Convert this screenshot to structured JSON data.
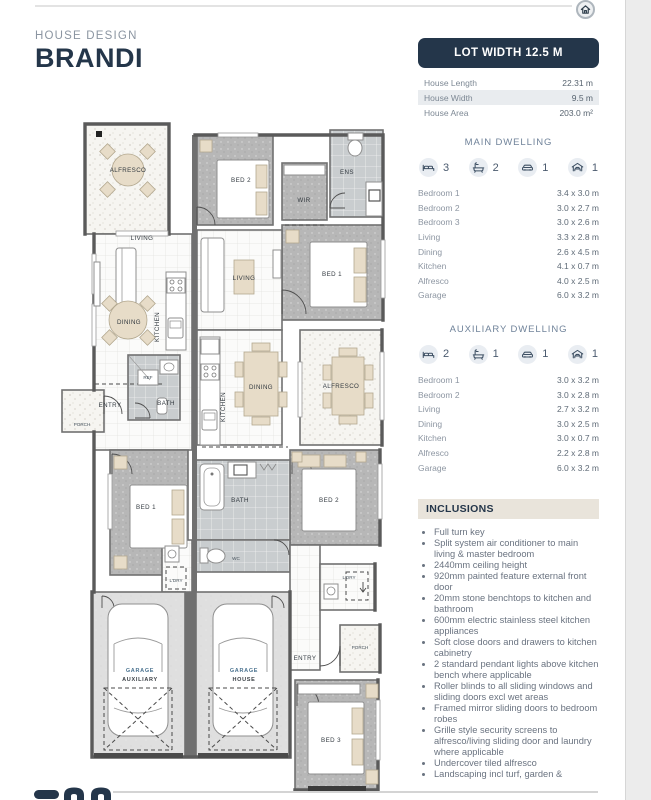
{
  "header": {
    "eyebrow": "HOUSE DESIGN",
    "title": "BRANDI"
  },
  "lot": {
    "header": "LOT WIDTH 12.5 M",
    "rows": [
      {
        "label": "House Length",
        "value": "22.31 m"
      },
      {
        "label": "House Width",
        "value": "9.5 m"
      },
      {
        "label": "House Area",
        "value": "203.0 m²"
      }
    ]
  },
  "main_dwelling": {
    "heading": "MAIN DWELLING",
    "stats": [
      {
        "icon": "bed-icon",
        "count": "3"
      },
      {
        "icon": "bath-icon",
        "count": "2"
      },
      {
        "icon": "car-icon",
        "count": "1"
      },
      {
        "icon": "garage-icon",
        "count": "1"
      }
    ],
    "rooms": [
      {
        "label": "Bedroom 1",
        "value": "3.4 x 3.0 m"
      },
      {
        "label": "Bedroom 2",
        "value": "3.0 x 2.7 m"
      },
      {
        "label": "Bedroom 3",
        "value": "3.0 x 2.6 m"
      },
      {
        "label": "Living",
        "value": "3.3 x 2.8 m"
      },
      {
        "label": "Dining",
        "value": "2.6 x 4.5 m"
      },
      {
        "label": "Kitchen",
        "value": "4.1 x 0.7 m"
      },
      {
        "label": "Alfresco",
        "value": "4.0 x 2.5 m"
      },
      {
        "label": "Garage",
        "value": "6.0 x 3.2 m"
      }
    ]
  },
  "auxiliary_dwelling": {
    "heading": "AUXILIARY DWELLING",
    "stats": [
      {
        "icon": "bed-icon",
        "count": "2"
      },
      {
        "icon": "bath-icon",
        "count": "1"
      },
      {
        "icon": "car-icon",
        "count": "1"
      },
      {
        "icon": "garage-icon",
        "count": "1"
      }
    ],
    "rooms": [
      {
        "label": "Bedroom 1",
        "value": "3.0 x 3.2 m"
      },
      {
        "label": "Bedroom 2",
        "value": "3.0 x 2.8 m"
      },
      {
        "label": "Living",
        "value": "2.7 x 3.2 m"
      },
      {
        "label": "Dining",
        "value": "3.0 x 2.5 m"
      },
      {
        "label": "Kitchen",
        "value": "3.0 x 0.7 m"
      },
      {
        "label": "Alfresco",
        "value": "2.2 x 2.8 m"
      },
      {
        "label": "Garage",
        "value": "6.0 x 3.2 m"
      }
    ]
  },
  "inclusions": {
    "heading": "INCLUSIONS",
    "items": [
      "Full turn key",
      "Split system air conditioner to main living & master bedroom",
      "2440mm ceiling height",
      "920mm painted feature external front door",
      "20mm stone benchtops to kitchen and bathroom",
      "600mm electric stainless steel kitchen appliances",
      "Soft close doors and drawers to kitchen cabinetry",
      "2 standard pendant lights above kitchen bench where applicable",
      "Roller blinds to all sliding windows and sliding doors excl wet areas",
      "Framed mirror sliding doors to bedroom robes",
      "Grille style security screens to alfresco/living sliding door and laundry where applicable",
      "Undercover tiled alfresco",
      "Landscaping incl turf, garden &"
    ]
  },
  "plan": {
    "labels": {
      "alfresco_a": "ALFRESCO",
      "living_a": "LIVING",
      "dining_a": "DINING",
      "kitchen_a": "KITCHEN",
      "entry_a": "ENTRY",
      "porch_a": "PORCH",
      "bath_a": "BATH",
      "ref": "REF",
      "bed1_a": "BED 1",
      "bed2_a": "BED 2",
      "ldry_a": "L'DRY",
      "garage_a1": "GARAGE",
      "garage_a2": "AUXILIARY",
      "garage_h1": "GARAGE",
      "garage_h2": "HOUSE",
      "wir": "WIR",
      "ens": "ENS",
      "bed1_m": "BED 1",
      "living_m": "LIVING",
      "kitchen_m": "KITCHEN",
      "dining_m": "DINING",
      "alfresco_m": "ALFRESCO",
      "bed2_m": "BED 2",
      "bath_m": "BATH",
      "wc": "WC",
      "ldry_m": "L'DRY",
      "entry_m": "ENTRY",
      "porch_m": "PORCH",
      "bed3": "BED 3"
    }
  },
  "colors": {
    "navy": "#24364a",
    "heading_blue": "#70839a",
    "row_bg": "#e9ecef",
    "inclusions_bg": "#e9e4db"
  }
}
